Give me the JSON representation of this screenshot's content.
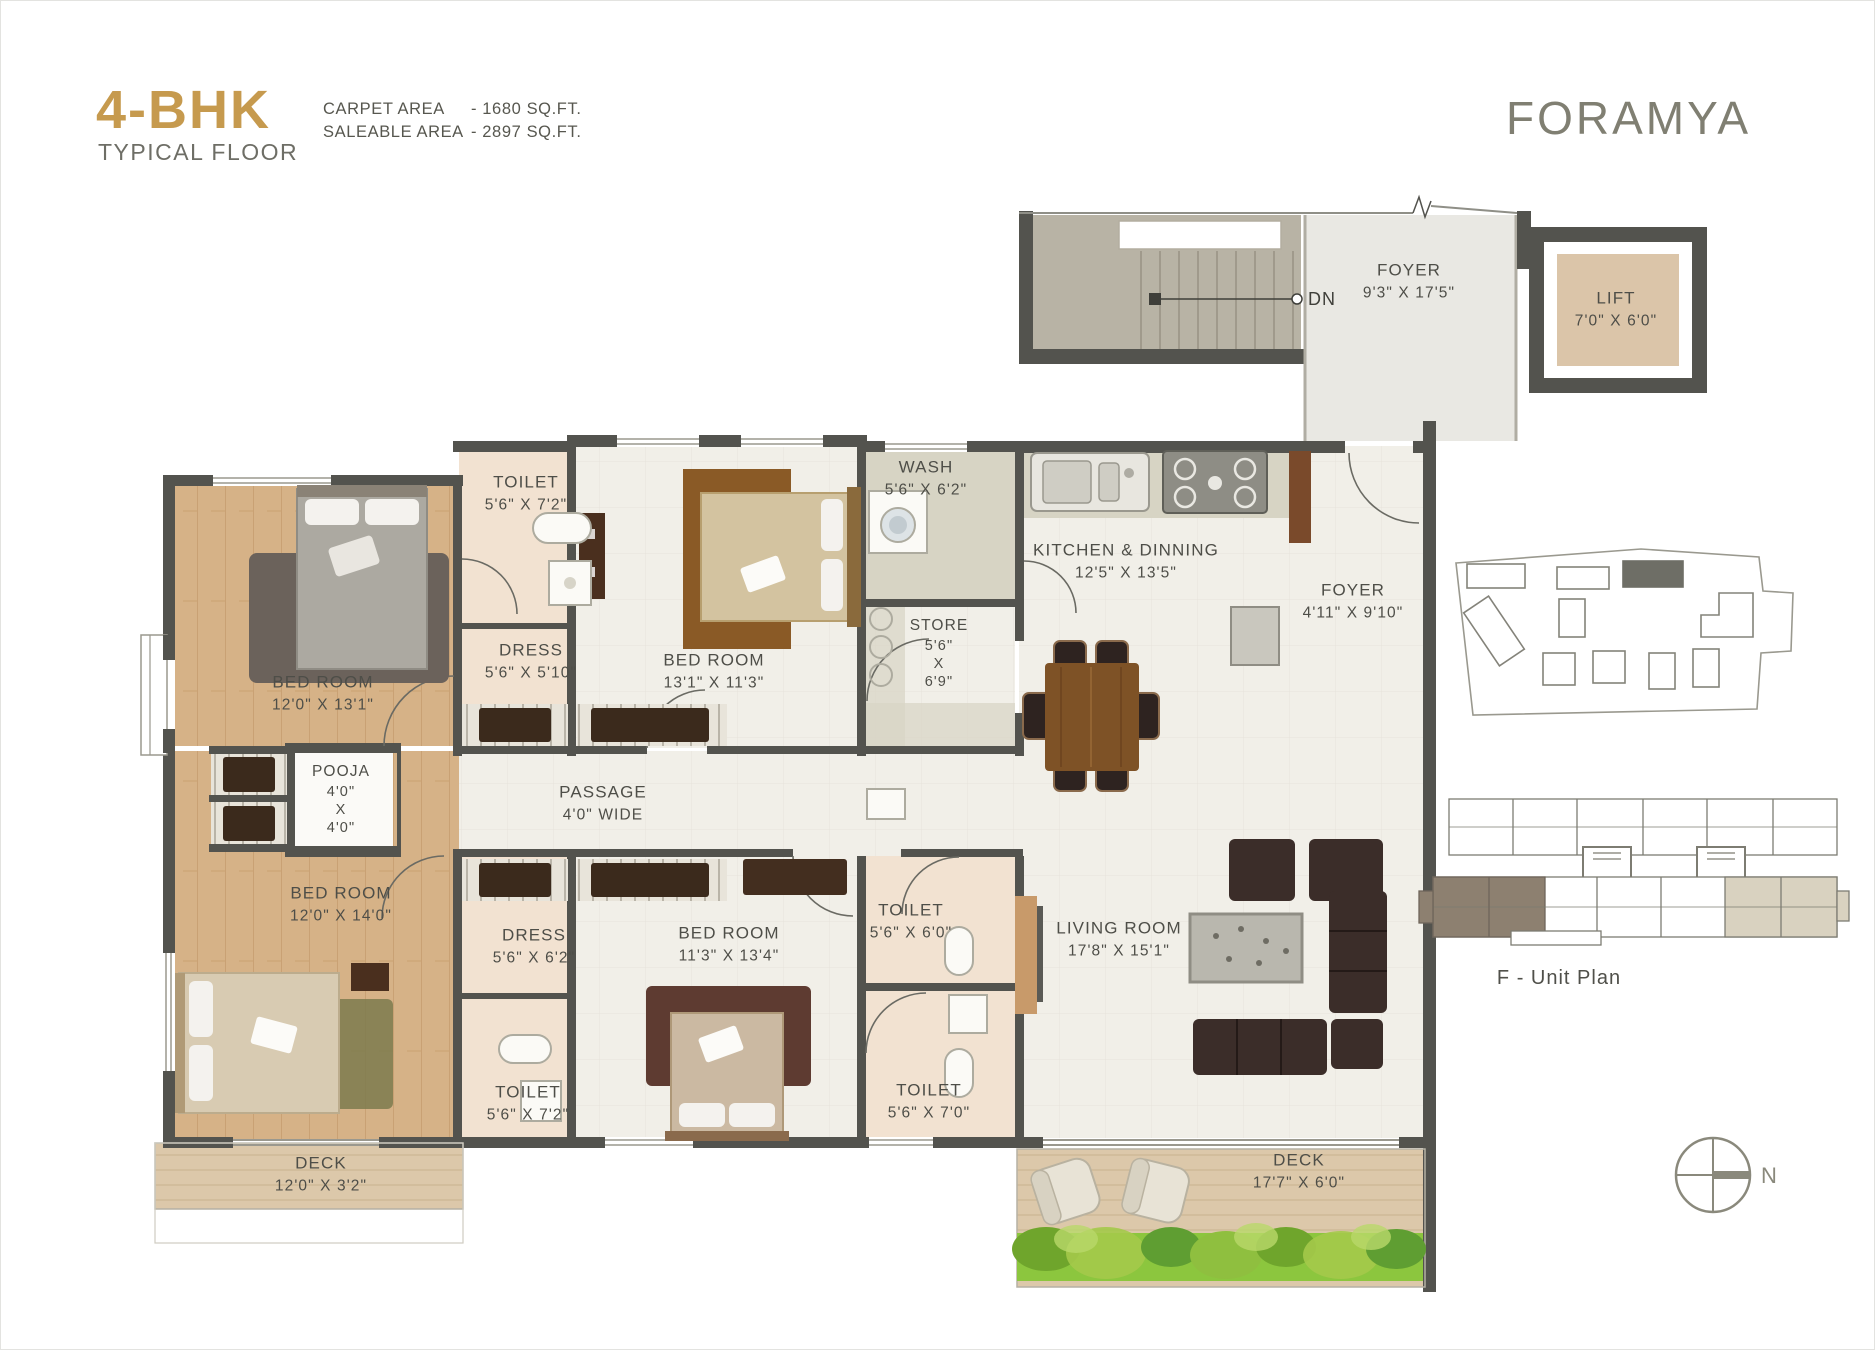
{
  "header": {
    "title": "4-BHK",
    "subtitle": "TYPICAL FLOOR",
    "carpet_area_label": "CARPET AREA",
    "carpet_area_value": "- 1680 SQ.FT.",
    "saleable_area_label": "SALEABLE AREA",
    "saleable_area_value": "- 2897 SQ.FT.",
    "brand": "FORAMYA"
  },
  "stairs": {
    "label": "DN"
  },
  "rooms": {
    "foyer_top": {
      "name": "FOYER",
      "dims": "9'3\" X 17'5\""
    },
    "lift": {
      "name": "LIFT",
      "dims": "7'0\" X 6'0\""
    },
    "toilet1": {
      "name": "TOILET",
      "dims": "5'6\" X 7'2\""
    },
    "dress1": {
      "name": "DRESS",
      "dims": "5'6\" X 5'10\""
    },
    "bedroom1": {
      "name": "BED ROOM",
      "dims": "12'0\" X 13'1\""
    },
    "bedroom2": {
      "name": "BED ROOM",
      "dims": "13'1\" X 11'3\""
    },
    "wash": {
      "name": "WASH",
      "dims": "5'6\" X 6'2\""
    },
    "store": {
      "name": "STORE",
      "l1": "5'6\"",
      "l2": "X",
      "l3": "6'9\""
    },
    "kitchen": {
      "name": "KITCHEN & DINNING",
      "dims": "12'5\" X 13'5\""
    },
    "foyer_inner": {
      "name": "FOYER",
      "dims": "4'11\" X 9'10\""
    },
    "pooja": {
      "name": "POOJA",
      "l1": "4'0\"",
      "l2": "X",
      "l3": "4'0\""
    },
    "passage": {
      "name": "PASSAGE",
      "dims": "4'0\" WIDE"
    },
    "bedroom3": {
      "name": "BED ROOM",
      "dims": "12'0\" X 14'0\""
    },
    "dress2": {
      "name": "DRESS",
      "dims": "5'6\" X 6'2\""
    },
    "toilet2": {
      "name": "TOILET",
      "dims": "5'6\" X 7'2\""
    },
    "bedroom4": {
      "name": "BED ROOM",
      "dims": "11'3\" X 13'4\""
    },
    "toilet3": {
      "name": "TOILET",
      "dims": "5'6\" X 6'0\""
    },
    "toilet4": {
      "name": "TOILET",
      "dims": "5'6\" X 7'0\""
    },
    "living": {
      "name": "LIVING ROOM",
      "dims": "17'8\" X 15'1\""
    },
    "deck1": {
      "name": "DECK",
      "dims": "12'0\" X 3'2\""
    },
    "deck2": {
      "name": "DECK",
      "dims": "17'7\" X 6'0\""
    }
  },
  "key_plans": {
    "unit_plan_label": "F - Unit Plan"
  },
  "compass": {
    "label": "N"
  },
  "colors": {
    "accent_gold": "#C69A4E",
    "brand_gray": "#807F72",
    "wall": "#53534E",
    "tile_floor": "#F1EFE8",
    "wood_floor": "#D6B287",
    "toilet_floor": "#F2E2D1",
    "utility_gray": "#D7D4C4",
    "deck_tan": "#DCC8AA",
    "stair_fill": "#B8B3A5",
    "furniture_dark": "#3B2D29",
    "greenery": "#8CC63E"
  }
}
